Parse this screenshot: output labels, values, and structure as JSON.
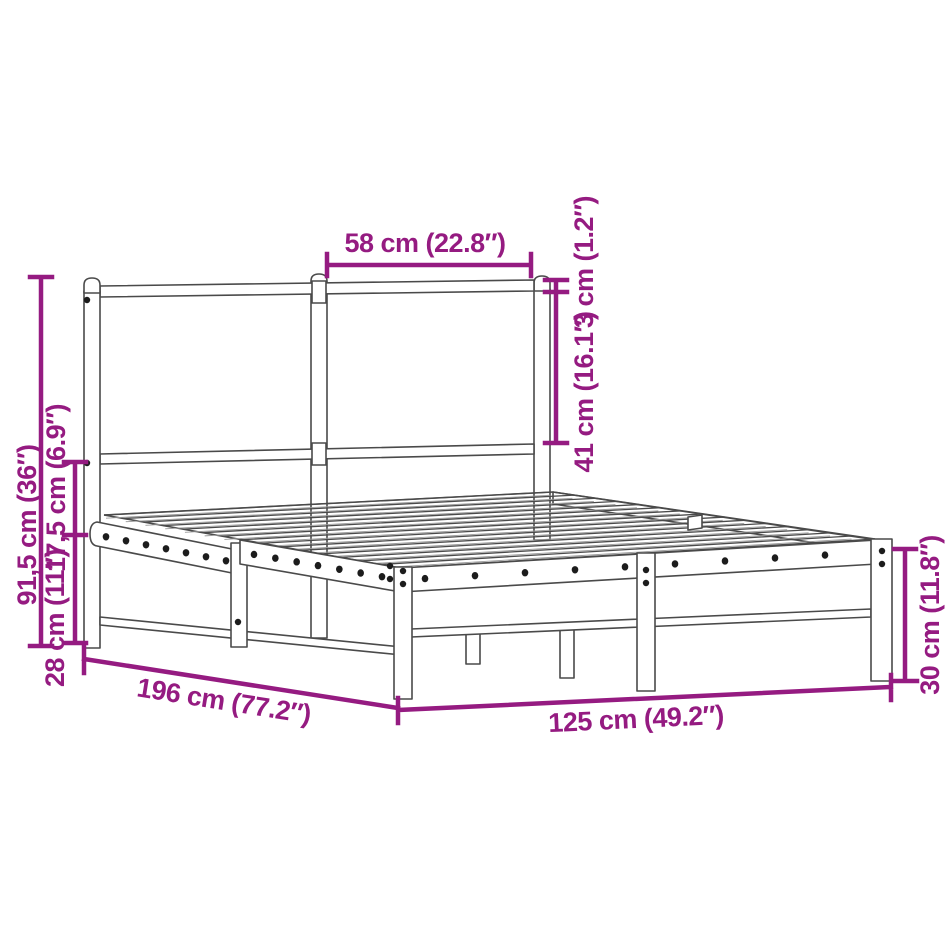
{
  "page": {
    "width": 947,
    "height": 947,
    "background": "#ffffff"
  },
  "diagram": {
    "type": "product-dimension-diagram",
    "subject": "metal bed frame with headboard",
    "accent_color": "#951b81",
    "line_color": "#4a4a4a",
    "dimensions": {
      "headboard_section_width": "58 cm (22.8″)",
      "headboard_top_rail": "3 cm (1.2″)",
      "headboard_panel_height": "41 cm (16.1″)",
      "overall_height": "91,5 cm (36″)",
      "headboard_clearance": "17,5 cm (6.9″)",
      "base_height": "28 cm (11″)",
      "frame_length": "196 cm (77.2″)",
      "frame_width": "125 cm (49.2″)",
      "footboard_height": "30 cm (11.8″)"
    },
    "counts": {
      "slats": 16,
      "side_rail_holes_head": 7,
      "side_rail_holes_foot": 7,
      "foot_rail_holes": 9,
      "screws": 11
    }
  }
}
